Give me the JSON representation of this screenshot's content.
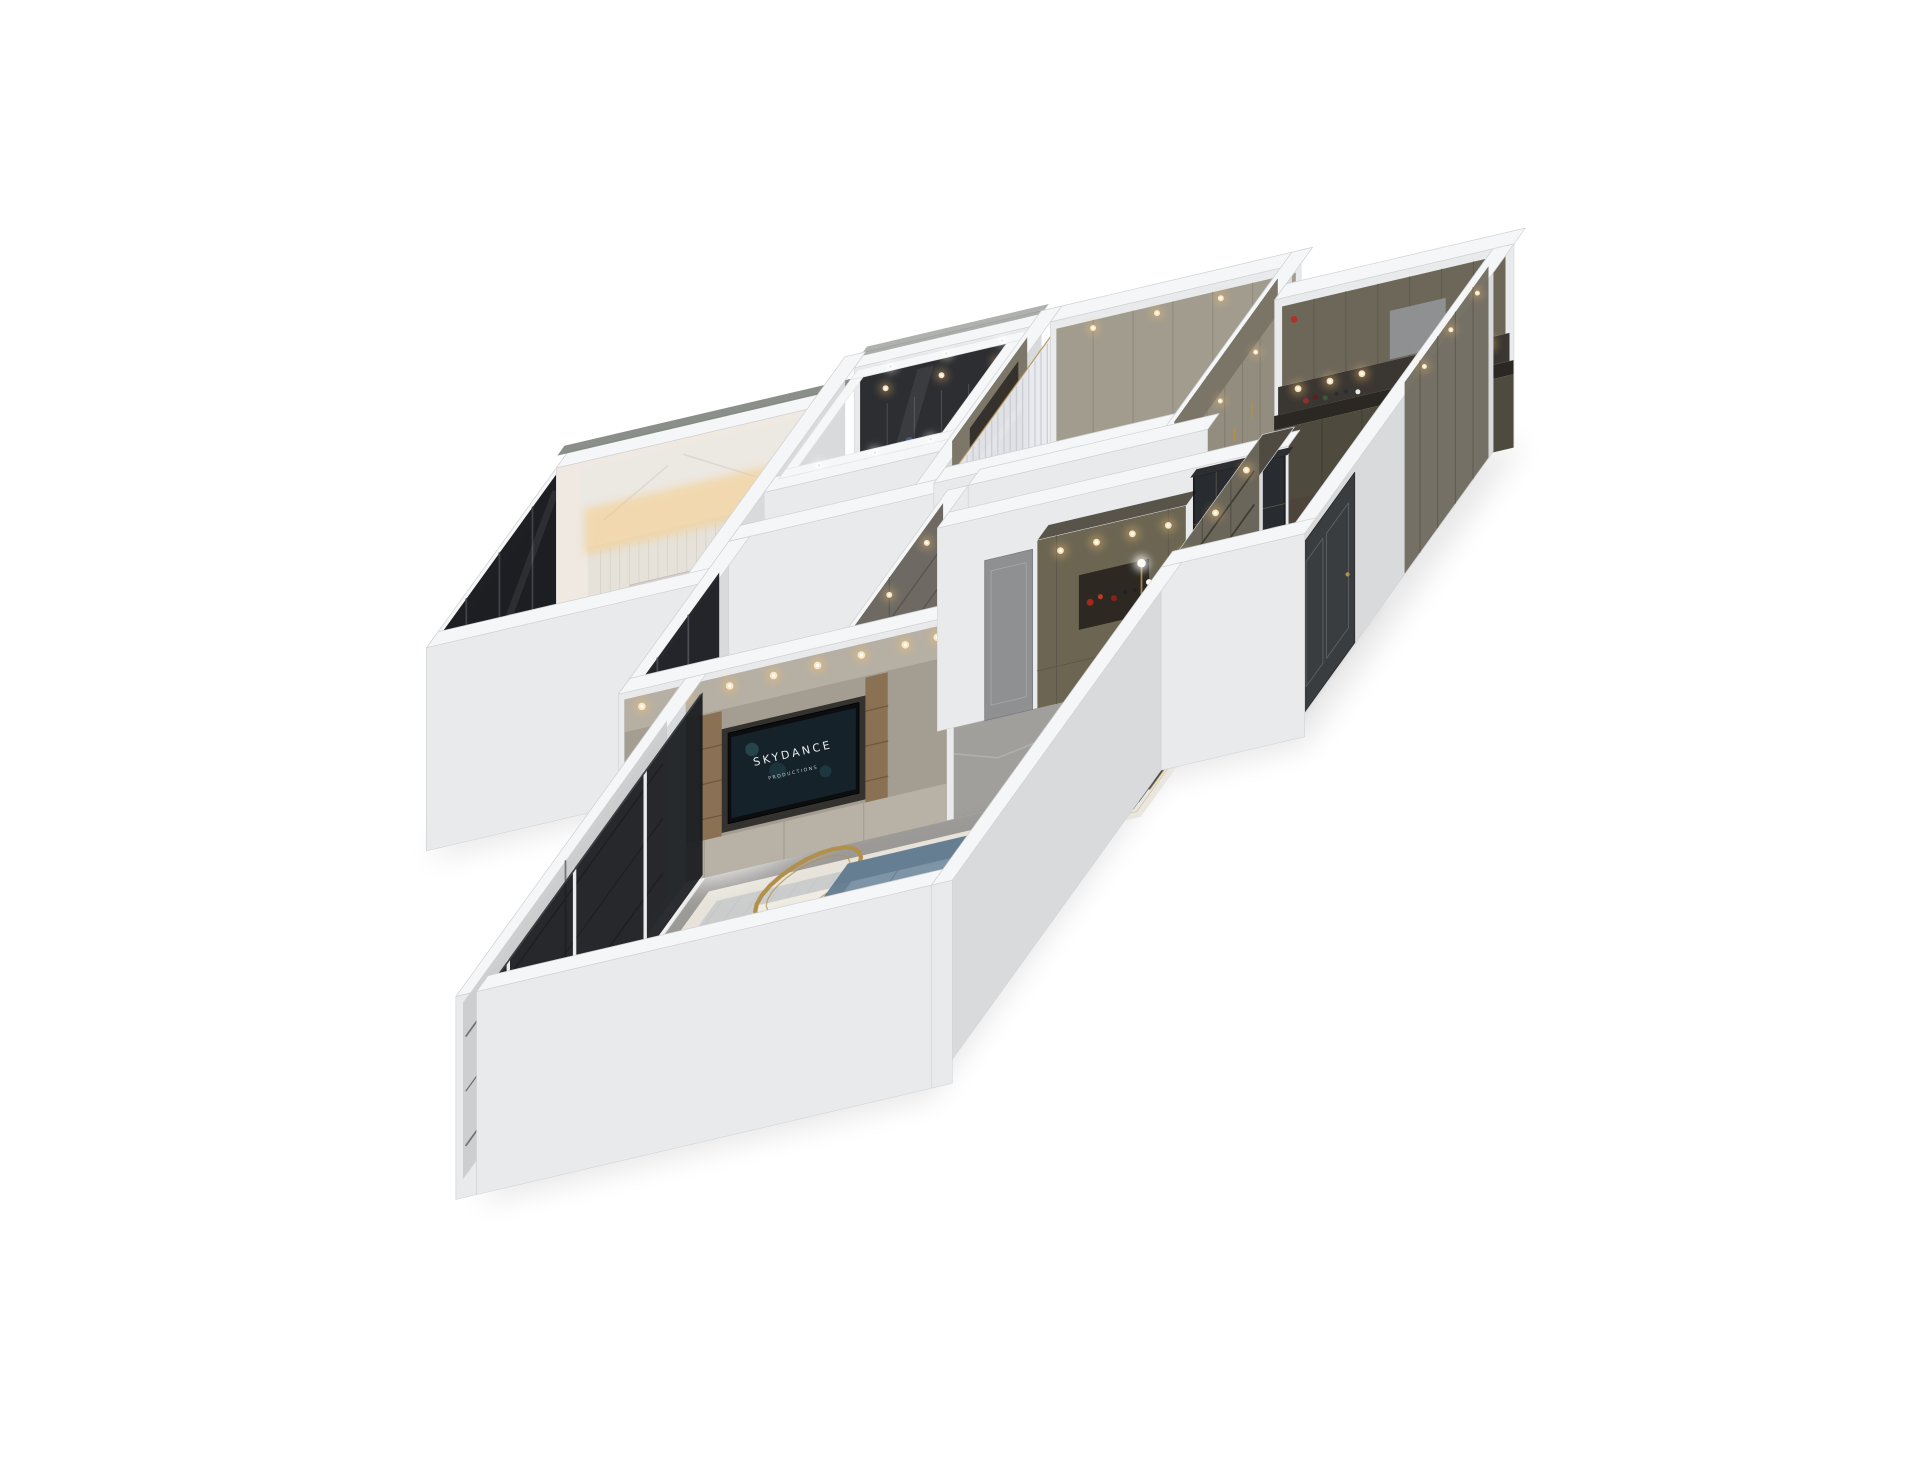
{
  "image": {
    "kind": "3d-apartment-dollhouse-render",
    "background": "#ffffff"
  },
  "tv": {
    "line1": "SKYDANCE",
    "line2": "PRODUCTIONS",
    "screen_color": "#16242c",
    "text_color": "#e9edef"
  },
  "palette": {
    "wall_top": "#f5f6f7",
    "wall_south": "#e9eaec",
    "wall_west": "#d8dadc",
    "wall_stroke": "#cfd1d4",
    "marble_floor": "#a19f9c",
    "marble_vein": "#c9c8c5",
    "bedroom_floor": "#ddd6cc",
    "closet_floor": "#443b32",
    "dressing_floor": "#cac2b3",
    "kitchen_floor": "#4d453b",
    "bright_floor": "#f3f1ed",
    "bath_floor": "#c6c6c4",
    "cabinet_taupe": "#938d7f",
    "cabinet_olive": "#6d675a",
    "cabinet_dark": "#2d2e32",
    "wardrobe_gray": "#6e6a63",
    "wood": "#8a6f50",
    "glass": "#14161a",
    "door_dark": "#3a3d40",
    "door_gray": "#8e9092",
    "sofa": "#7e95a7",
    "sofa_dark": "#667e91",
    "chair_teal": "#597580",
    "table_dark": "#46494d",
    "coffee_table": "#564d54",
    "gold": "#b2904c",
    "warm_light": "#f2c173",
    "glow_warm": "#f6c97e",
    "rug_light": "#e7e3da",
    "rug_blue": "#b4bac1",
    "rug_inlay": "#efece4",
    "dining_rug": "#e9e6df",
    "bed_head": "#d6cdc9",
    "duvet": "#fafafa",
    "armchair": "#d8caa5"
  },
  "rooms": [
    "master-bedroom",
    "walk-in-closet",
    "dressing-room",
    "kitchen",
    "bathroom",
    "second-bedroom",
    "living-room",
    "dining-area",
    "entry-hall"
  ]
}
